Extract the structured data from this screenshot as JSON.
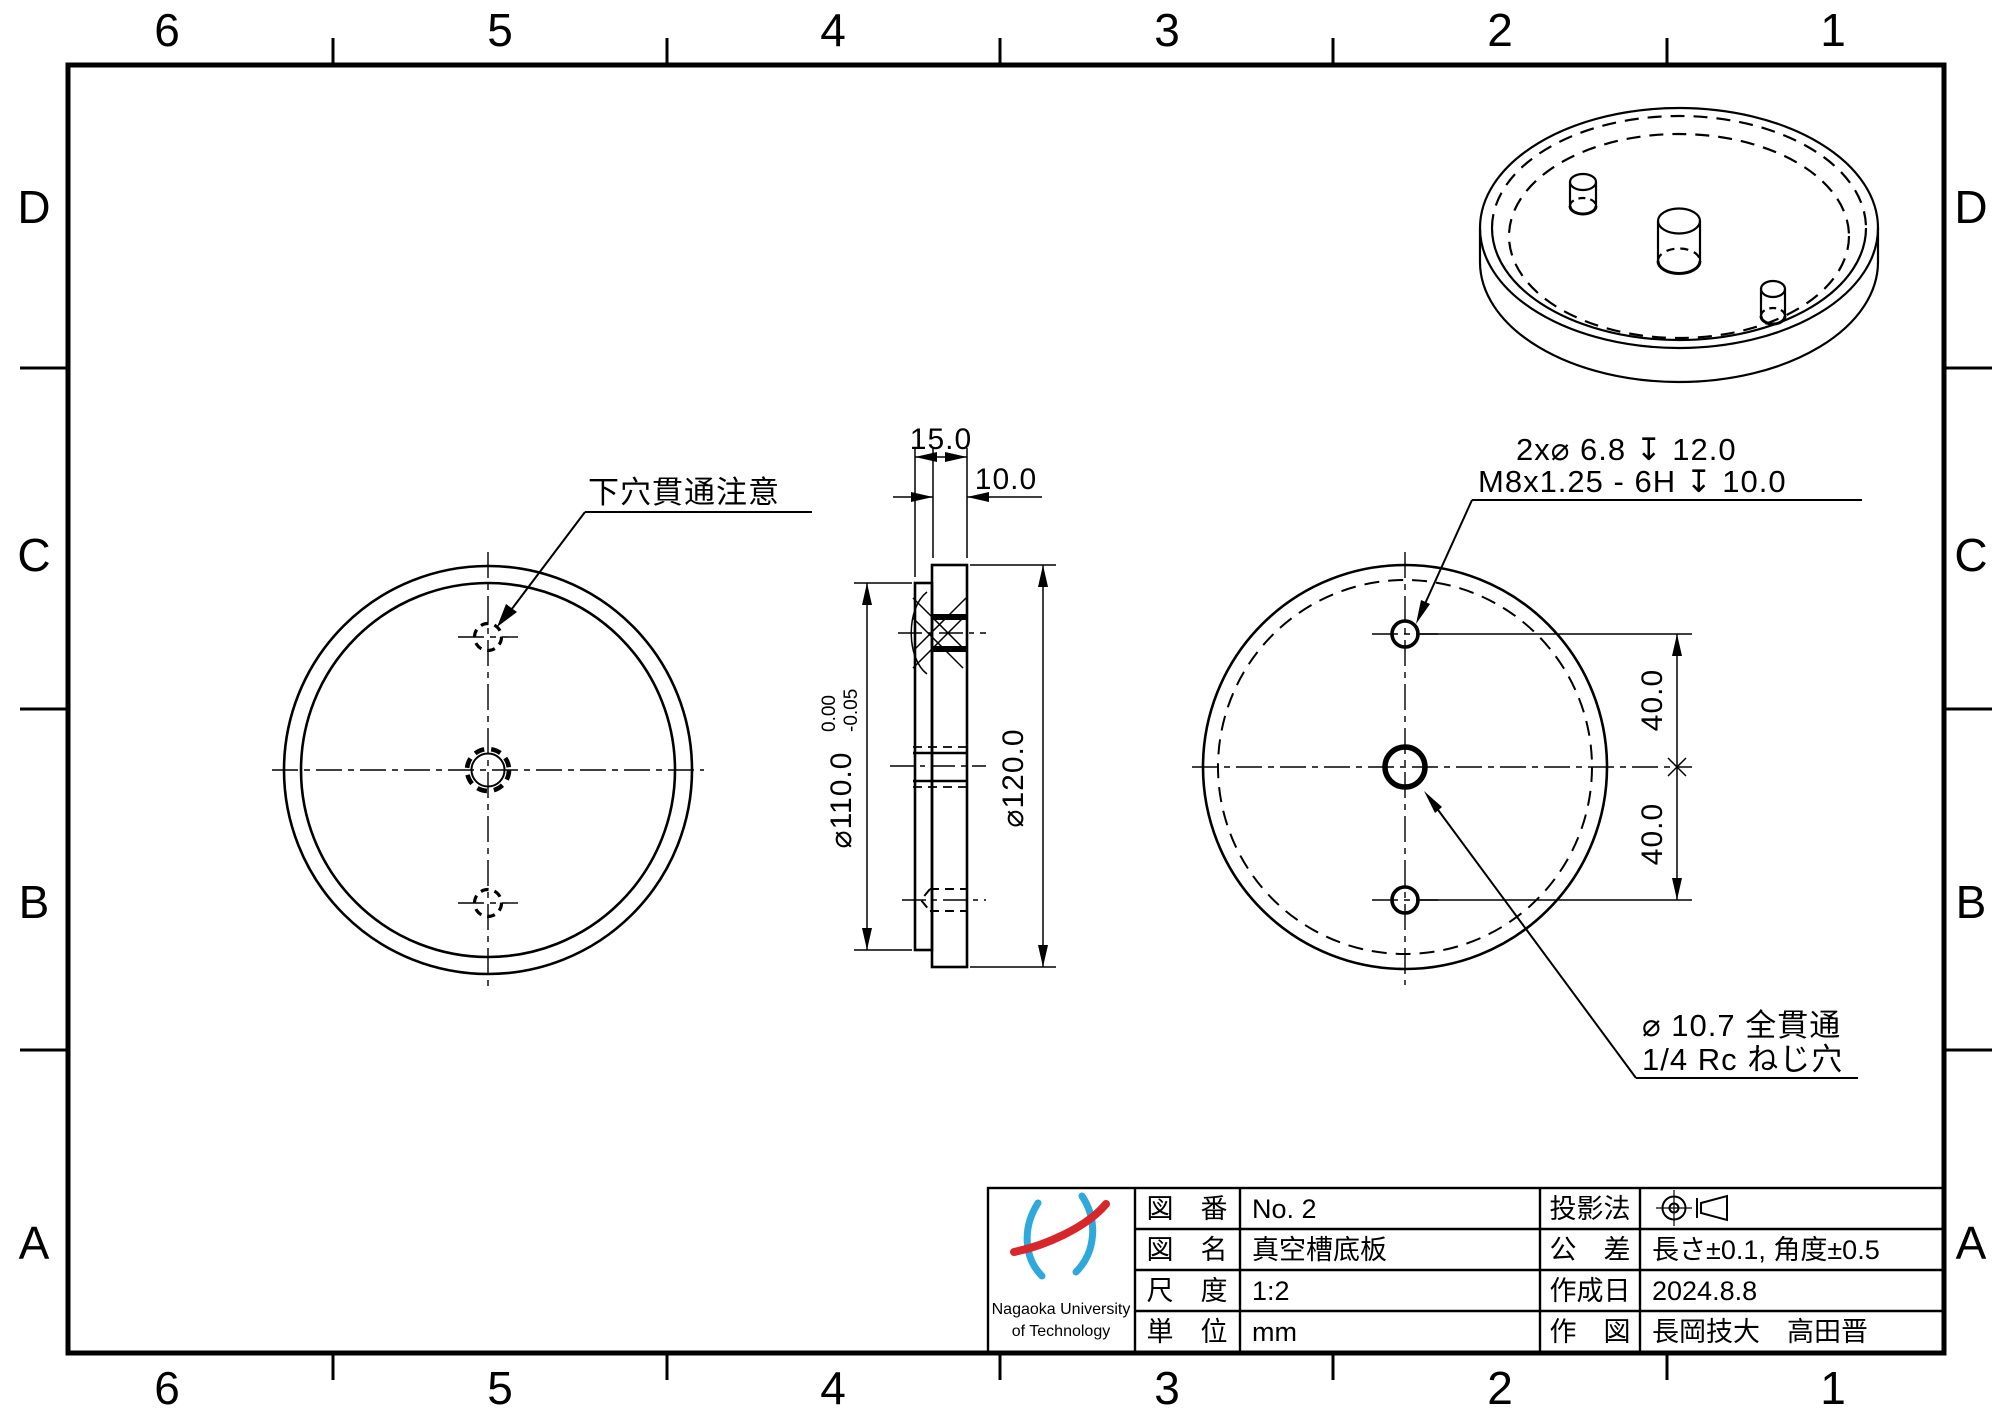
{
  "colors": {
    "line": "#000000",
    "logo_blue": "#2fa8dc",
    "logo_red": "#d7262c"
  },
  "drawing": {
    "zones": {
      "columns": [
        "6",
        "5",
        "4",
        "3",
        "2",
        "1"
      ],
      "rows": [
        "D",
        "C",
        "B",
        "A"
      ]
    },
    "notes": {
      "pilot_hole": "下穴貫通注意",
      "tapped_hole_line1": "2x⌀ 6.8 ↧ 12.0",
      "tapped_hole_line2": "M8x1.25 - 6H ↧ 10.0",
      "center_hole_line1": "⌀ 10.7 全貫通",
      "center_hole_line2": "1/4 Rc ねじ穴"
    },
    "dims": {
      "total_thickness": "15.0",
      "plate_thickness": "10.0",
      "outer_dia": "⌀120.0",
      "boss_dia": "⌀110.0",
      "boss_tol_upper": "0.00",
      "boss_tol_lower": "-0.05",
      "hole_pitch_upper": "40.0",
      "hole_pitch_lower": "40.0"
    },
    "title_block": {
      "logo_text_line1": "Nagaoka University",
      "logo_text_line2": "of Technology",
      "drawing_no_label": "図　番",
      "drawing_no": "No. 2",
      "drawing_name_label": "図　名",
      "drawing_name": "真空槽底板",
      "scale_label": "尺　度",
      "scale": "1:2",
      "unit_label": "単　位",
      "unit": "mm",
      "projection_label": "投影法",
      "tolerance_label": "公　差",
      "tolerance": "長さ±0.1, 角度±0.5",
      "date_label": "作成日",
      "date": "2024.8.8",
      "drawn_by_label": "作　図",
      "drawn_by": "長岡技大　高田晋"
    }
  }
}
